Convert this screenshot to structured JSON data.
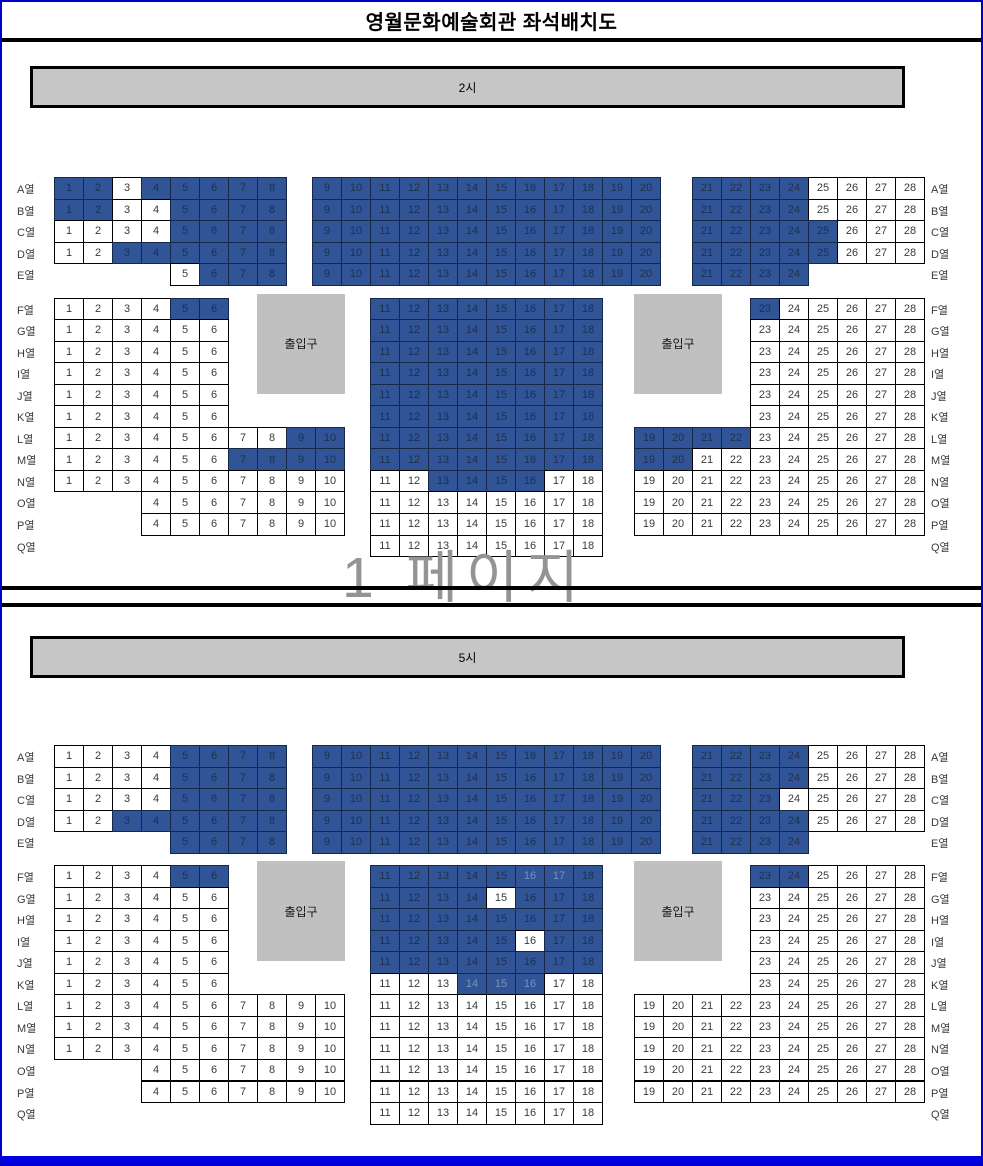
{
  "title": "영월문화예술회관 좌석배치도",
  "watermark": "1 페이지",
  "entrance_label": "출입구",
  "row_suffix": "열",
  "colors": {
    "seat_reserved": "#305496",
    "seat_reserved_text": "#1E2F50",
    "seat_available": "#FFFFFF",
    "seat_text": "#3A3A3A",
    "seat_faint_text": "#7A90BE",
    "stage_fill": "#C6C6C6",
    "entrance_fill": "#C0C0C0",
    "cell_border": "#000000",
    "page_border": "#0000CC",
    "bottom_bar": "#0000E0",
    "watermark": "#949494"
  },
  "sections": [
    {
      "stage_label": "2시",
      "rows": [
        {
          "label": "A",
          "blocks": [
            [
              "left",
              1,
              8
            ],
            [
              "mid",
              9,
              20
            ],
            [
              "right",
              21,
              28
            ]
          ],
          "reserved": [
            [
              1,
              2
            ],
            [
              4,
              24
            ]
          ],
          "faint": []
        },
        {
          "label": "B",
          "blocks": [
            [
              "left",
              1,
              8
            ],
            [
              "mid",
              9,
              20
            ],
            [
              "right",
              21,
              28
            ]
          ],
          "reserved": [
            [
              1,
              2
            ],
            [
              5,
              24
            ]
          ],
          "faint": []
        },
        {
          "label": "C",
          "blocks": [
            [
              "left",
              1,
              8
            ],
            [
              "mid",
              9,
              20
            ],
            [
              "right",
              21,
              28
            ]
          ],
          "reserved": [
            [
              5,
              25
            ]
          ],
          "faint": []
        },
        {
          "label": "D",
          "blocks": [
            [
              "left",
              1,
              8
            ],
            [
              "mid",
              9,
              20
            ],
            [
              "right",
              21,
              28
            ]
          ],
          "reserved": [
            [
              3,
              25
            ]
          ],
          "faint": []
        },
        {
          "label": "E",
          "blocks": [
            [
              "left",
              5,
              8
            ],
            [
              "mid",
              9,
              20
            ],
            [
              "right",
              21,
              24
            ]
          ],
          "reserved": [
            [
              6,
              24
            ]
          ],
          "faint": []
        },
        {
          "label": "F",
          "blocks": [
            [
              "left",
              1,
              6
            ],
            [
              "mid",
              11,
              18
            ],
            [
              "right",
              23,
              28
            ]
          ],
          "reserved": [
            [
              5,
              6
            ],
            [
              11,
              18
            ],
            [
              23,
              23
            ]
          ],
          "faint": []
        },
        {
          "label": "G",
          "blocks": [
            [
              "left",
              1,
              6
            ],
            [
              "mid",
              11,
              18
            ],
            [
              "right",
              23,
              28
            ]
          ],
          "reserved": [
            [
              11,
              18
            ]
          ],
          "faint": []
        },
        {
          "label": "H",
          "blocks": [
            [
              "left",
              1,
              6
            ],
            [
              "mid",
              11,
              18
            ],
            [
              "right",
              23,
              28
            ]
          ],
          "reserved": [
            [
              11,
              18
            ]
          ],
          "faint": []
        },
        {
          "label": "I",
          "blocks": [
            [
              "left",
              1,
              6
            ],
            [
              "mid",
              11,
              18
            ],
            [
              "right",
              23,
              28
            ]
          ],
          "reserved": [
            [
              11,
              18
            ]
          ],
          "faint": []
        },
        {
          "label": "J",
          "blocks": [
            [
              "left",
              1,
              6
            ],
            [
              "mid",
              11,
              18
            ],
            [
              "right",
              23,
              28
            ]
          ],
          "reserved": [
            [
              11,
              18
            ]
          ],
          "faint": []
        },
        {
          "label": "K",
          "blocks": [
            [
              "left",
              1,
              6
            ],
            [
              "mid",
              11,
              18
            ],
            [
              "right",
              23,
              28
            ]
          ],
          "reserved": [
            [
              11,
              18
            ]
          ],
          "faint": []
        },
        {
          "label": "L",
          "blocks": [
            [
              "left",
              1,
              10
            ],
            [
              "mid",
              11,
              18
            ],
            [
              "right",
              19,
              28
            ]
          ],
          "reserved": [
            [
              9,
              22
            ]
          ],
          "faint": []
        },
        {
          "label": "M",
          "blocks": [
            [
              "left",
              1,
              10
            ],
            [
              "mid",
              11,
              18
            ],
            [
              "right",
              19,
              28
            ]
          ],
          "reserved": [
            [
              7,
              20
            ]
          ],
          "faint": []
        },
        {
          "label": "N",
          "blocks": [
            [
              "left",
              1,
              10
            ],
            [
              "mid",
              11,
              18
            ],
            [
              "right",
              19,
              28
            ]
          ],
          "reserved": [
            [
              13,
              16
            ]
          ],
          "faint": []
        },
        {
          "label": "O",
          "blocks": [
            [
              "left",
              4,
              10
            ],
            [
              "mid",
              11,
              18
            ],
            [
              "right",
              19,
              28
            ]
          ],
          "reserved": [],
          "faint": []
        },
        {
          "label": "P",
          "blocks": [
            [
              "left",
              4,
              10
            ],
            [
              "mid",
              11,
              18
            ],
            [
              "right",
              19,
              28
            ]
          ],
          "reserved": [],
          "faint": []
        },
        {
          "label": "Q",
          "blocks": [
            [
              "mid",
              11,
              18
            ]
          ],
          "reserved": [],
          "faint": []
        }
      ]
    },
    {
      "stage_label": "5시",
      "rows": [
        {
          "label": "A",
          "blocks": [
            [
              "left",
              1,
              8
            ],
            [
              "mid",
              9,
              20
            ],
            [
              "right",
              21,
              28
            ]
          ],
          "reserved": [
            [
              5,
              24
            ]
          ],
          "faint": []
        },
        {
          "label": "B",
          "blocks": [
            [
              "left",
              1,
              8
            ],
            [
              "mid",
              9,
              20
            ],
            [
              "right",
              21,
              28
            ]
          ],
          "reserved": [
            [
              5,
              24
            ]
          ],
          "faint": []
        },
        {
          "label": "C",
          "blocks": [
            [
              "left",
              1,
              8
            ],
            [
              "mid",
              9,
              20
            ],
            [
              "right",
              21,
              28
            ]
          ],
          "reserved": [
            [
              5,
              23
            ]
          ],
          "faint": []
        },
        {
          "label": "D",
          "blocks": [
            [
              "left",
              1,
              8
            ],
            [
              "mid",
              9,
              20
            ],
            [
              "right",
              21,
              28
            ]
          ],
          "reserved": [
            [
              3,
              24
            ]
          ],
          "faint": []
        },
        {
          "label": "E",
          "blocks": [
            [
              "left",
              5,
              8
            ],
            [
              "mid",
              9,
              20
            ],
            [
              "right",
              21,
              24
            ]
          ],
          "reserved": [
            [
              5,
              24
            ]
          ],
          "faint": []
        },
        {
          "label": "F",
          "blocks": [
            [
              "left",
              1,
              6
            ],
            [
              "mid",
              11,
              18
            ],
            [
              "right",
              23,
              28
            ]
          ],
          "reserved": [
            [
              5,
              6
            ],
            [
              11,
              18
            ],
            [
              23,
              24
            ]
          ],
          "faint": [
            16,
            17
          ]
        },
        {
          "label": "G",
          "blocks": [
            [
              "left",
              1,
              6
            ],
            [
              "mid",
              11,
              18
            ],
            [
              "right",
              23,
              28
            ]
          ],
          "reserved": [
            [
              11,
              14
            ],
            [
              16,
              18
            ]
          ],
          "faint": []
        },
        {
          "label": "H",
          "blocks": [
            [
              "left",
              1,
              6
            ],
            [
              "mid",
              11,
              18
            ],
            [
              "right",
              23,
              28
            ]
          ],
          "reserved": [
            [
              11,
              18
            ]
          ],
          "faint": []
        },
        {
          "label": "I",
          "blocks": [
            [
              "left",
              1,
              6
            ],
            [
              "mid",
              11,
              18
            ],
            [
              "right",
              23,
              28
            ]
          ],
          "reserved": [
            [
              11,
              15
            ],
            [
              17,
              18
            ]
          ],
          "faint": []
        },
        {
          "label": "J",
          "blocks": [
            [
              "left",
              1,
              6
            ],
            [
              "mid",
              11,
              18
            ],
            [
              "right",
              23,
              28
            ]
          ],
          "reserved": [
            [
              11,
              18
            ]
          ],
          "faint": []
        },
        {
          "label": "K",
          "blocks": [
            [
              "left",
              1,
              6
            ],
            [
              "mid",
              11,
              18
            ],
            [
              "right",
              23,
              28
            ]
          ],
          "reserved": [
            [
              14,
              16
            ]
          ],
          "faint": [
            14,
            15,
            16
          ]
        },
        {
          "label": "L",
          "blocks": [
            [
              "left",
              1,
              10
            ],
            [
              "mid",
              11,
              18
            ],
            [
              "right",
              19,
              28
            ]
          ],
          "reserved": [],
          "faint": []
        },
        {
          "label": "M",
          "blocks": [
            [
              "left",
              1,
              10
            ],
            [
              "mid",
              11,
              18
            ],
            [
              "right",
              19,
              28
            ]
          ],
          "reserved": [],
          "faint": []
        },
        {
          "label": "N",
          "blocks": [
            [
              "left",
              1,
              10
            ],
            [
              "mid",
              11,
              18
            ],
            [
              "right",
              19,
              28
            ]
          ],
          "reserved": [],
          "faint": []
        },
        {
          "label": "O",
          "blocks": [
            [
              "left",
              4,
              10
            ],
            [
              "mid",
              11,
              18
            ],
            [
              "right",
              19,
              28
            ]
          ],
          "reserved": [],
          "faint": []
        },
        {
          "label": "P",
          "blocks": [
            [
              "left",
              4,
              10
            ],
            [
              "mid",
              11,
              18
            ],
            [
              "right",
              19,
              28
            ]
          ],
          "reserved": [],
          "faint": []
        },
        {
          "label": "Q",
          "blocks": [
            [
              "mid",
              11,
              18
            ]
          ],
          "reserved": [],
          "faint": []
        }
      ]
    }
  ]
}
